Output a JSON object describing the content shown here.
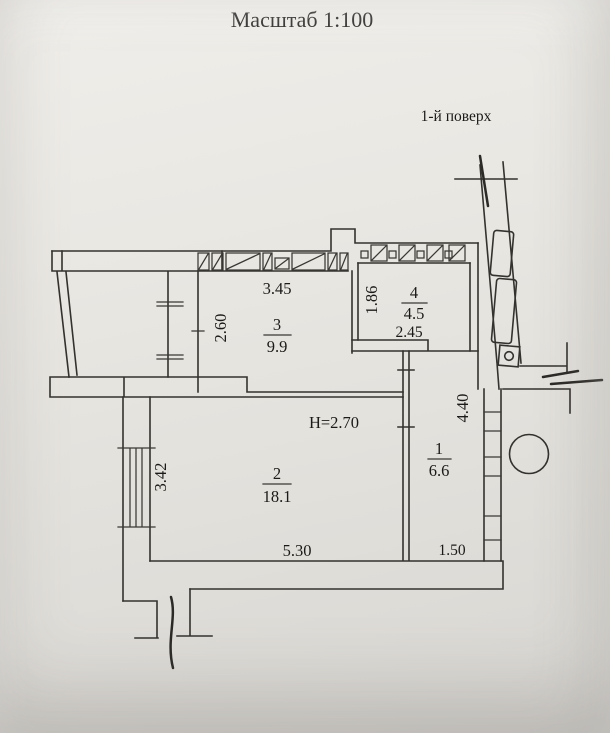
{
  "document": {
    "title": "Масштаб 1:100",
    "floor_label": "1-й поверх"
  },
  "rooms": [
    {
      "number": "1",
      "area": "6.6"
    },
    {
      "number": "2",
      "area": "18.1"
    },
    {
      "number": "3",
      "area": "9.9"
    },
    {
      "number": "4",
      "area": "4.5"
    }
  ],
  "dimensions": {
    "room3_width": "3.45",
    "room3_depth": "2.60",
    "room4_depth": "1.86",
    "room4_width": "2.45",
    "room2_width": "5.30",
    "room1_width": "1.50",
    "left_wall": "3.42",
    "right_wall": "4.40",
    "ceiling_height": "H=2.70"
  },
  "colors": {
    "paper": "#e8e6e1",
    "ink": "#34322e",
    "text": "#1b1a18"
  }
}
